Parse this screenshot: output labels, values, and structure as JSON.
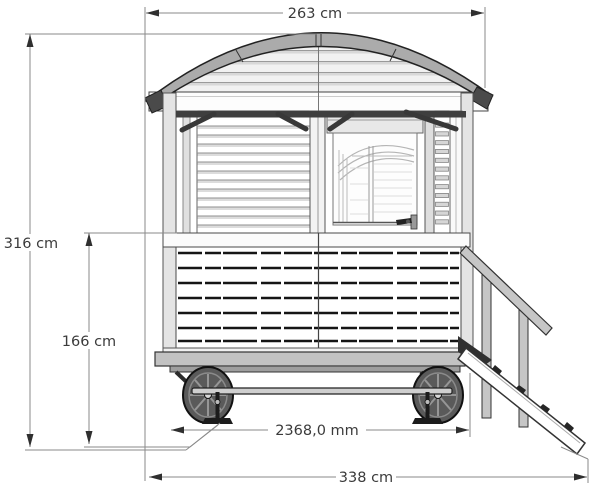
{
  "dimensions": {
    "roof_width": "263 cm",
    "overall_height": "316 cm",
    "interior_floor_height": "166 cm",
    "chassis_length_mm": "2368,0 mm",
    "overall_length": "338 cm"
  },
  "colors": {
    "roof_band": "#ababab",
    "fascia": "#f1f1f1",
    "wheel": "#5a5a5a",
    "chassis": "#c2c2c2",
    "rail_wood": "#c6c6c6",
    "dim_line": "#8a8a8a",
    "text": "#3b3b3b"
  }
}
